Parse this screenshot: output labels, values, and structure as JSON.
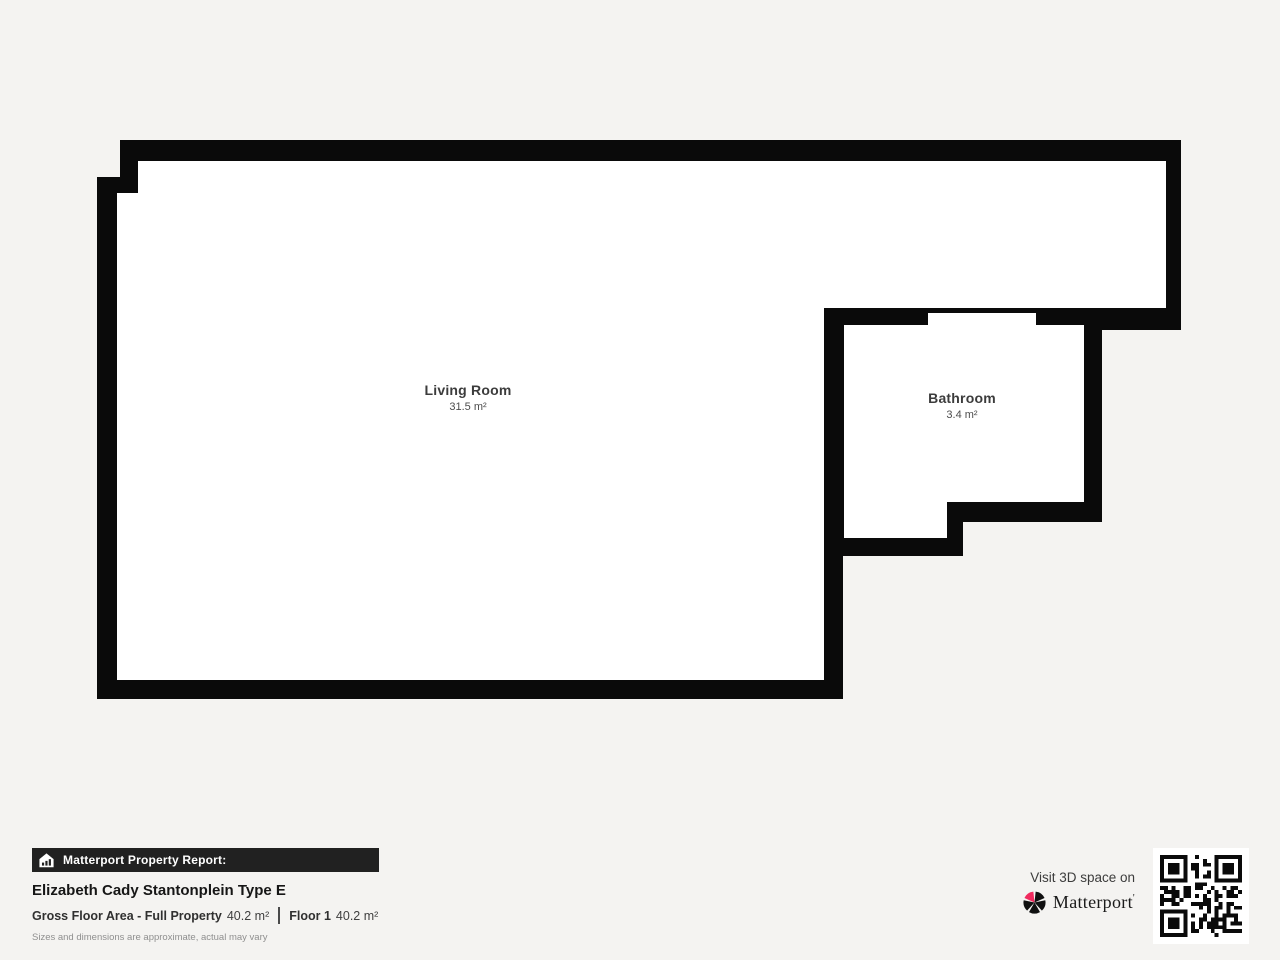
{
  "colors": {
    "background": "#f4f3f1",
    "wall": "#0a0a0a",
    "floor": "#ffffff",
    "banner_bg": "#212121",
    "brand_accent": "#f02a5e"
  },
  "floorplan": {
    "rooms": [
      {
        "name": "Living Room",
        "area": "31.5 m²"
      },
      {
        "name": "Bathroom",
        "area": "3.4 m²"
      }
    ]
  },
  "report": {
    "banner": "Matterport Property Report:",
    "property_name": "Elizabeth Cady Stantonplein Type E",
    "gross_label": "Gross Floor Area - Full Property",
    "gross_value": "40.2 m²",
    "floor_label": "Floor 1",
    "floor_value": "40.2 m²",
    "disclaimer": "Sizes and dimensions are approximate, actual may vary"
  },
  "cta": {
    "visit_text": "Visit 3D space on",
    "brand": "Matterport",
    "brand_mark": "'"
  }
}
